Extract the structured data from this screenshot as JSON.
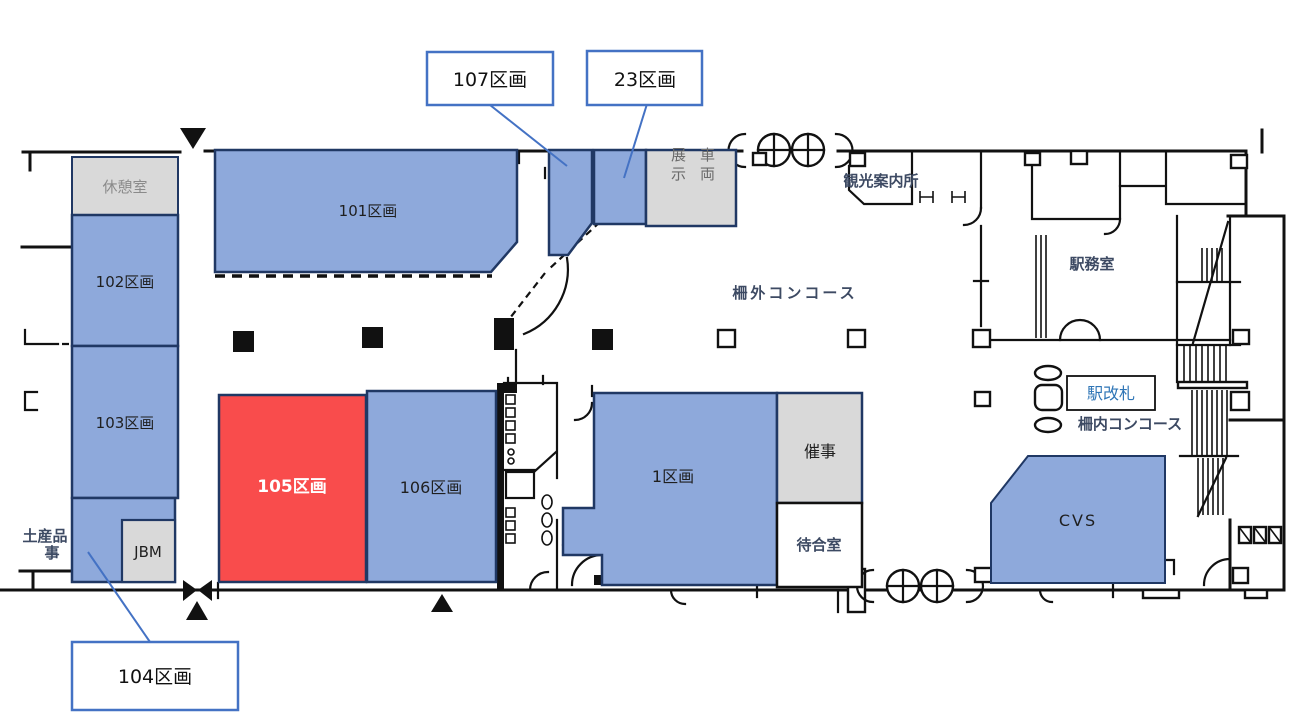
{
  "colors": {
    "section_blue": "#8EA9DB",
    "section_border": "#203864",
    "highlight_red": "#F94C4C",
    "facility_gray": "#D9D9D9",
    "callout_border": "#4472C4",
    "gate_text_blue": "#2E75B6",
    "scan_text": "#3D4A63"
  },
  "sections": {
    "s101": {
      "label": "101区画"
    },
    "s102": {
      "label": "102区画"
    },
    "s103": {
      "label": "103区画"
    },
    "s105": {
      "label": "105区画",
      "highlighted": "red"
    },
    "s106": {
      "label": "106区画"
    },
    "s1": {
      "label": "1区画"
    },
    "cvs": {
      "label": "CVS"
    }
  },
  "callouts": {
    "c107": {
      "label": "107区画"
    },
    "c23": {
      "label": "23区画"
    },
    "c104": {
      "label": "104区画"
    }
  },
  "facilities": {
    "rest_room": "休憩室",
    "jbm": "JBM",
    "exhibit_col1": "展示",
    "exhibit_col2": "車両",
    "event_space": "催事",
    "waiting_room": "待合室",
    "station_gate": "駅改札",
    "tourist_info": "観光案内所",
    "station_office": "駅務室",
    "concourse_outside": "柵外コンコース",
    "concourse_inside": "柵内コンコース",
    "souvenir_line1": "土産品",
    "souvenir_line2": "事"
  }
}
